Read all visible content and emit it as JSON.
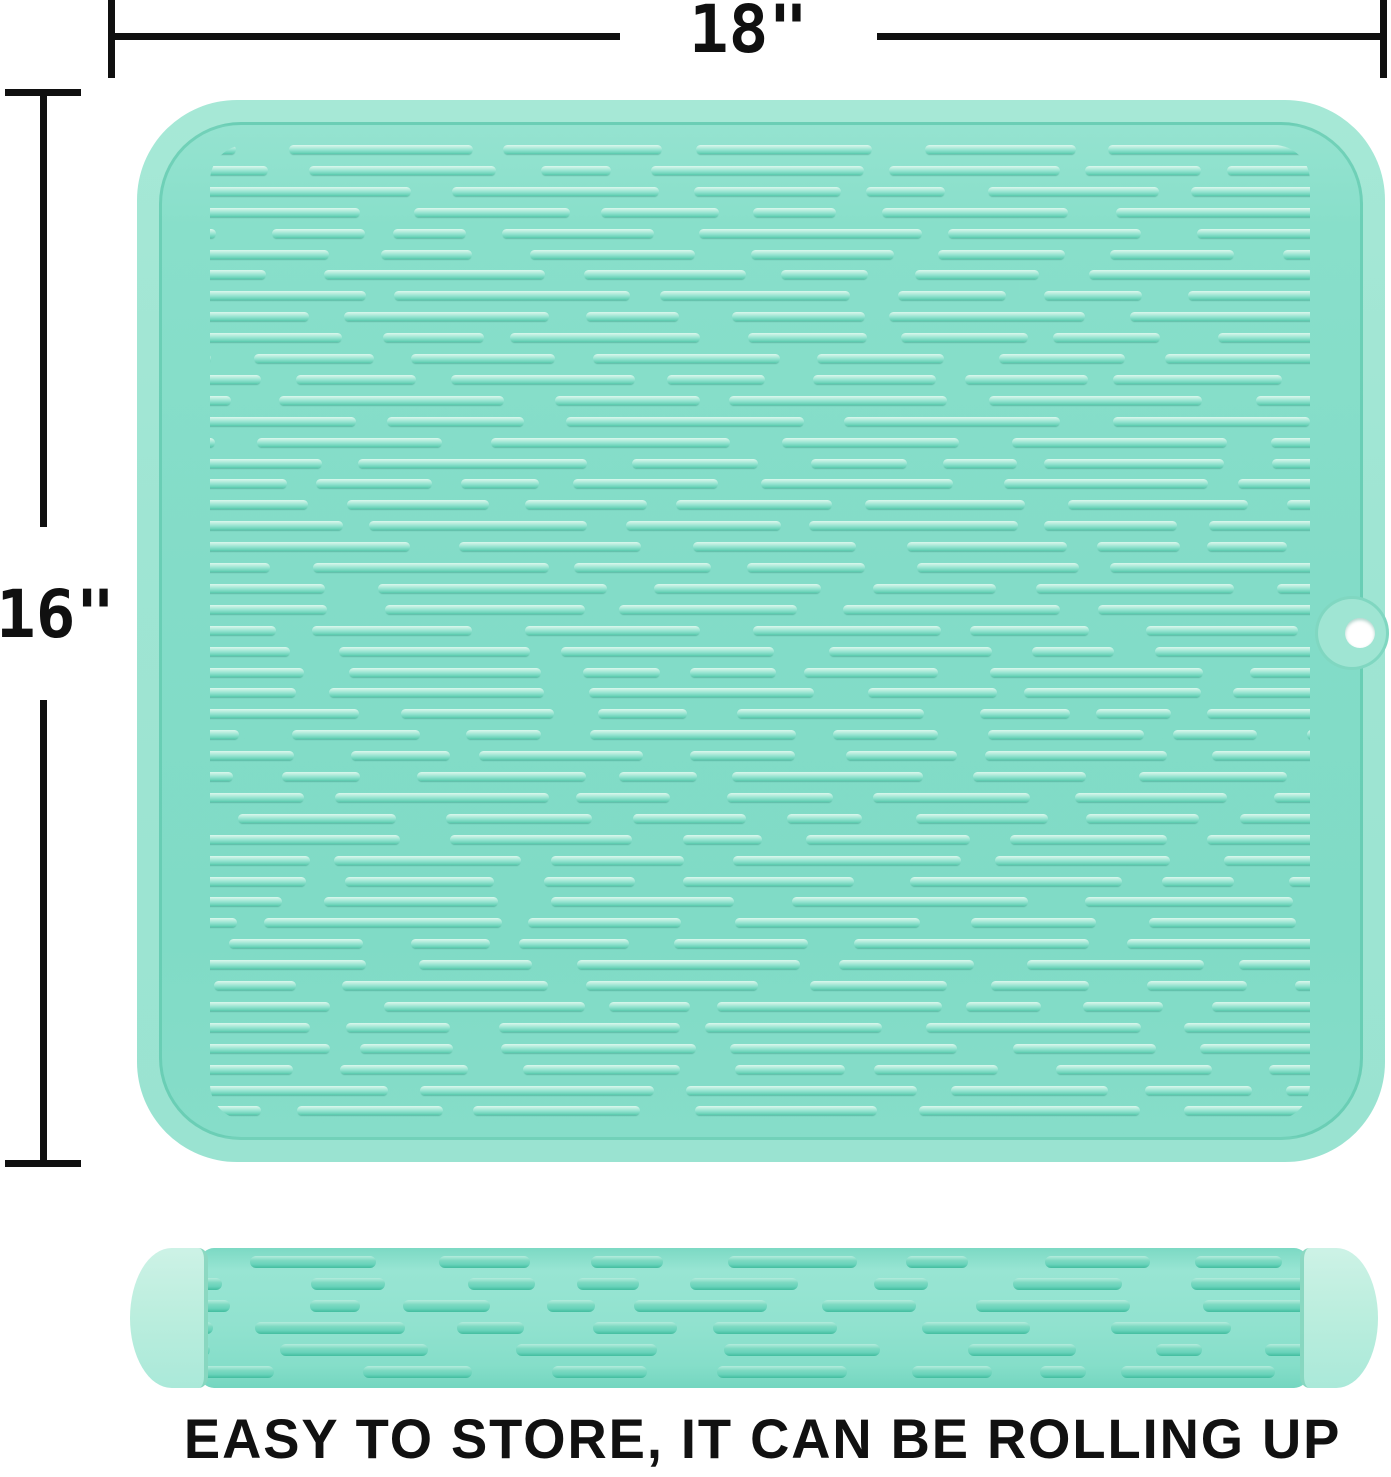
{
  "dimensions": {
    "width_label": "18\"",
    "height_label": "16\""
  },
  "caption": "EASY TO STORE, IT CAN BE ROLLING UP",
  "colors": {
    "background": "#ffffff",
    "dimension_line": "#101010",
    "caption_color": "#111111",
    "mat_rim": "#9fe5d3",
    "mat_surface": "#83dcc8",
    "mat_surface_light": "#95e3d0",
    "groove": "#4fc0a2",
    "ridge_highlight": "#daf8ed",
    "ridge_mid": "#93e3d0",
    "ridge_shadow": "#57c8ac",
    "roll_cap": "#bceede",
    "roll_body": "#91e2cf",
    "roll_ridge": "#68d3ba",
    "roll_ridge_shadow": "#43bd9f",
    "hole": "#ffffff"
  }
}
